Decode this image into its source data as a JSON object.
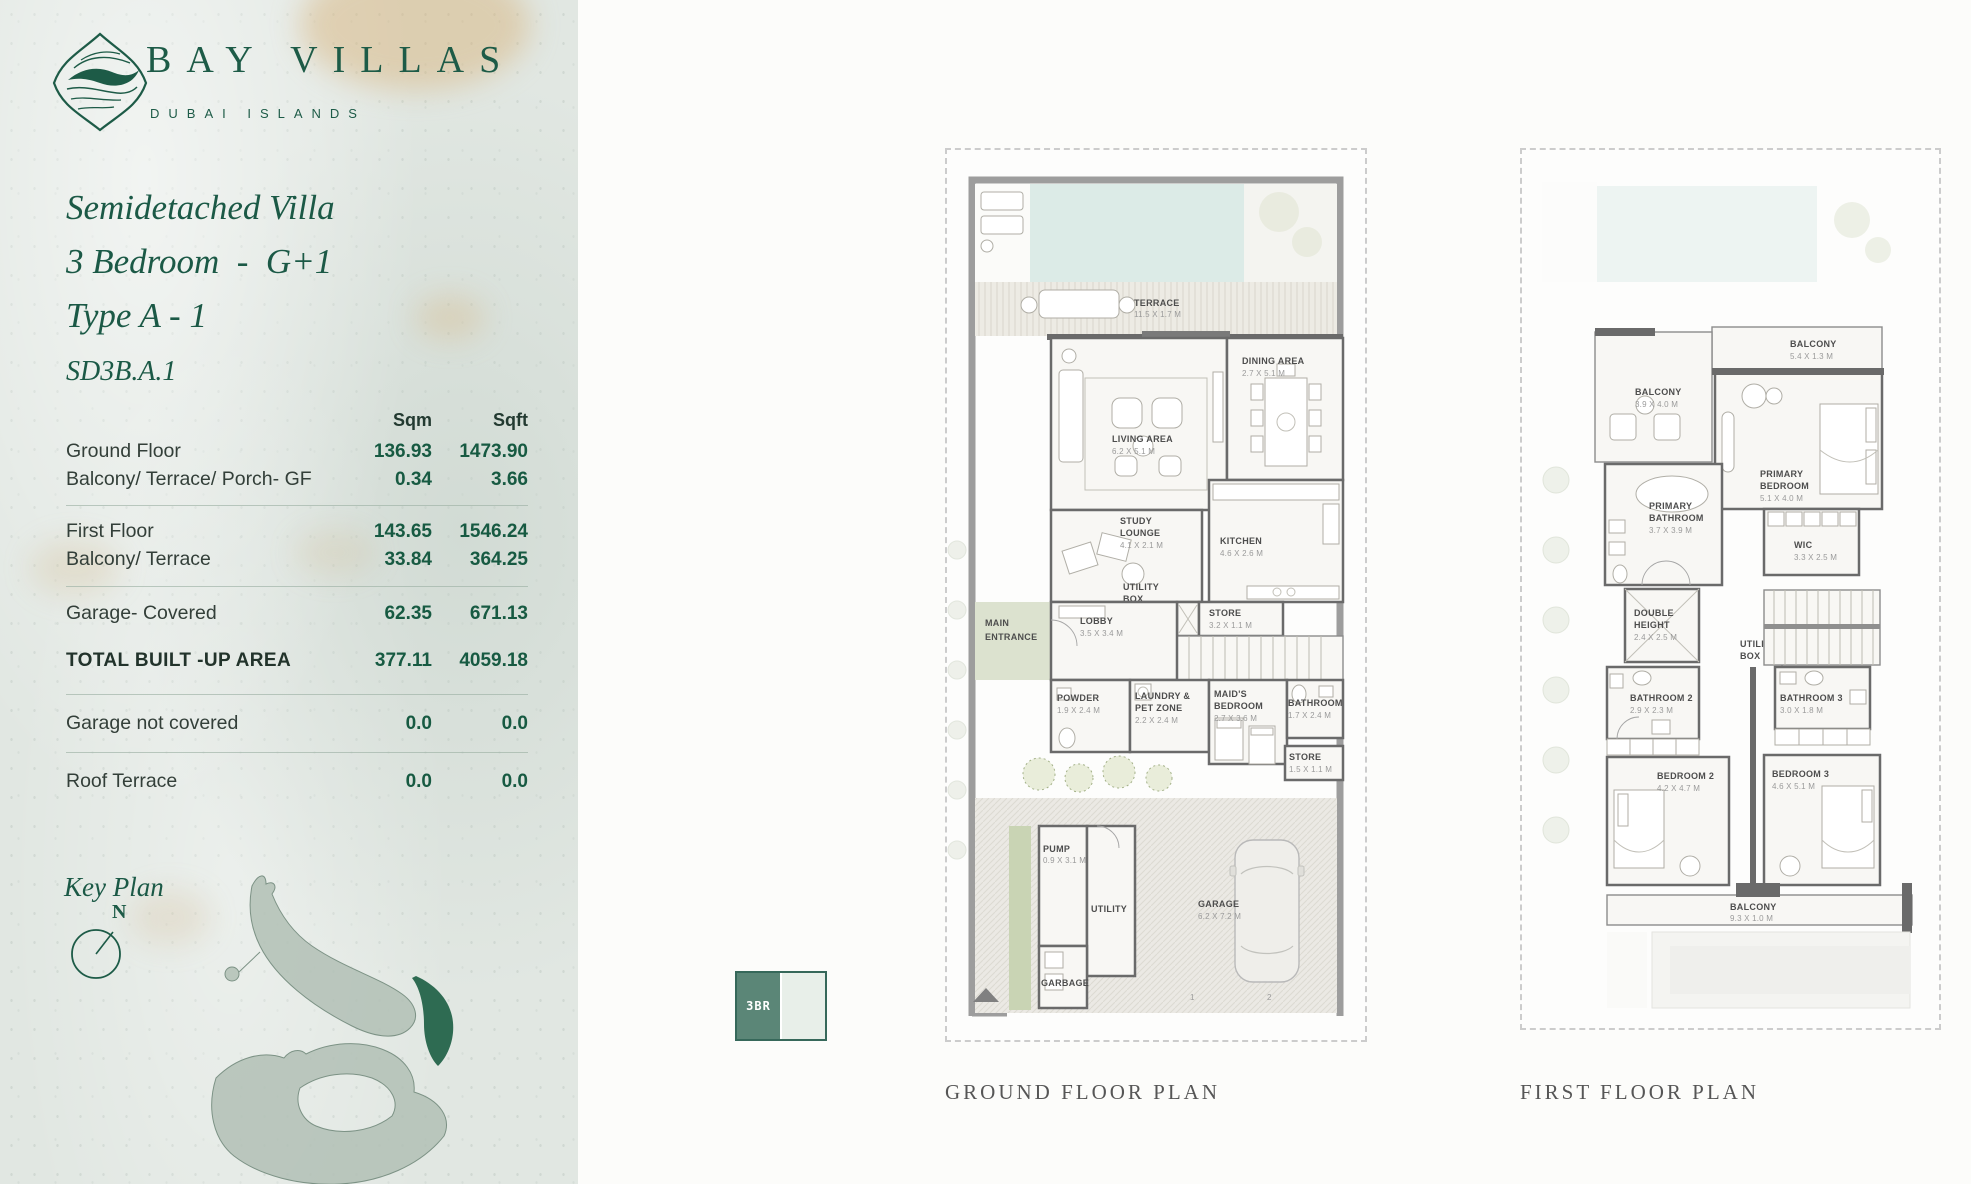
{
  "brand": {
    "name": "BAY VILLAS",
    "tagline": "DUBAI ISLANDS"
  },
  "heading": {
    "line1": "Semidetached Villa",
    "line2": "3 Bedroom  -  G+1",
    "line3": "Type A - 1",
    "code": "SD3B.A.1"
  },
  "table": {
    "headers": {
      "sqm": "Sqm",
      "sqft": "Sqft"
    },
    "rows": [
      {
        "label": "Ground Floor",
        "sqm": "136.93",
        "sqft": "1473.90"
      },
      {
        "label": "Balcony/ Terrace/ Porch- GF",
        "sqm": "0.34",
        "sqft": "3.66"
      },
      {
        "label": "First Floor",
        "sqm": "143.65",
        "sqft": "1546.24"
      },
      {
        "label": "Balcony/ Terrace",
        "sqm": "33.84",
        "sqft": "364.25"
      },
      {
        "label": "Garage- Covered",
        "sqm": "62.35",
        "sqft": "671.13"
      },
      {
        "label": "TOTAL BUILT -UP AREA",
        "sqm": "377.11",
        "sqft": "4059.18"
      },
      {
        "label": "Garage not covered",
        "sqm": "0.0",
        "sqft": "0.0"
      },
      {
        "label": "Roof Terrace",
        "sqm": "0.0",
        "sqft": "0.0"
      }
    ]
  },
  "key_plan": {
    "title": "Key Plan",
    "compass_n": "N"
  },
  "legend": {
    "label": "3BR"
  },
  "ground_plan": {
    "caption": "GROUND FLOOR PLAN",
    "rooms": {
      "terrace": {
        "name": "TERRACE",
        "dims": "11.5 X 1.7 M"
      },
      "living": {
        "name": "LIVING AREA",
        "dims": "6.2 X 5.1 M"
      },
      "dining": {
        "name": "DINING AREA",
        "dims": "2.7 X 5.1 M"
      },
      "study": {
        "n1": "STUDY",
        "n2": "LOUNGE",
        "dims": "4.1 X 2.1 M"
      },
      "kitchen": {
        "name": "KITCHEN",
        "dims": "4.6 X 2.6 M"
      },
      "utility_box": {
        "n1": "UTILITY",
        "n2": "BOX"
      },
      "store1": {
        "name": "STORE",
        "dims": "3.2 X 1.1 M"
      },
      "main_entrance": {
        "n1": "MAIN",
        "n2": "ENTRANCE"
      },
      "lobby": {
        "name": "LOBBY",
        "dims": "3.5 X 3.4 M"
      },
      "powder": {
        "name": "POWDER",
        "dims": "1.9 X 2.4 M"
      },
      "laundry": {
        "n1": "LAUNDRY &",
        "n2": "PET ZONE",
        "dims": "2.2 X 2.4 M"
      },
      "maid": {
        "n1": "MAID'S",
        "n2": "BEDROOM",
        "dims": "2.7 X 3.6 M"
      },
      "bathroom": {
        "name": "BATHROOM",
        "dims": "1.7 X 2.4 M"
      },
      "store2": {
        "name": "STORE",
        "dims": "1.5 X 1.1 M"
      },
      "pump": {
        "name": "PUMP",
        "dims": "0.9 X 3.1 M"
      },
      "utility": {
        "name": "UTILITY"
      },
      "garbage": {
        "name": "GARBAGE"
      },
      "garage": {
        "name": "GARAGE",
        "dims": "6.2 X 7.2 M"
      },
      "spot1": "1",
      "spot2": "2"
    }
  },
  "first_plan": {
    "caption": "FIRST FLOOR PLAN",
    "rooms": {
      "balcony_top": {
        "name": "BALCONY",
        "dims": "5.4 X 1.3 M"
      },
      "balcony_left": {
        "name": "BALCONY",
        "dims": "3.9 X 4.0 M"
      },
      "primary_bedroom": {
        "n1": "PRIMARY",
        "n2": "BEDROOM",
        "dims": "5.1 X 4.0 M"
      },
      "primary_bathroom": {
        "n1": "PRIMARY",
        "n2": "BATHROOM",
        "dims": "3.7 X 3.9 M"
      },
      "wic": {
        "name": "WIC",
        "dims": "3.3 X 2.5 M"
      },
      "double_height": {
        "n1": "DOUBLE",
        "n2": "HEIGHT",
        "dims": "2.4 X 2.5 M"
      },
      "utility_box": {
        "n1": "UTILITY",
        "n2": "BOX"
      },
      "bathroom2": {
        "name": "BATHROOM 2",
        "dims": "2.9 X 2.3 M"
      },
      "bathroom3": {
        "name": "BATHROOM 3",
        "dims": "3.0 X 1.8 M"
      },
      "bedroom2": {
        "name": "BEDROOM 2",
        "dims": "4.2 X 4.7 M"
      },
      "bedroom3": {
        "name": "BEDROOM 3",
        "dims": "4.6 X 5.1 M"
      },
      "balcony_bottom": {
        "name": "BALCONY",
        "dims": "9.3 X 1.0 M"
      }
    }
  }
}
